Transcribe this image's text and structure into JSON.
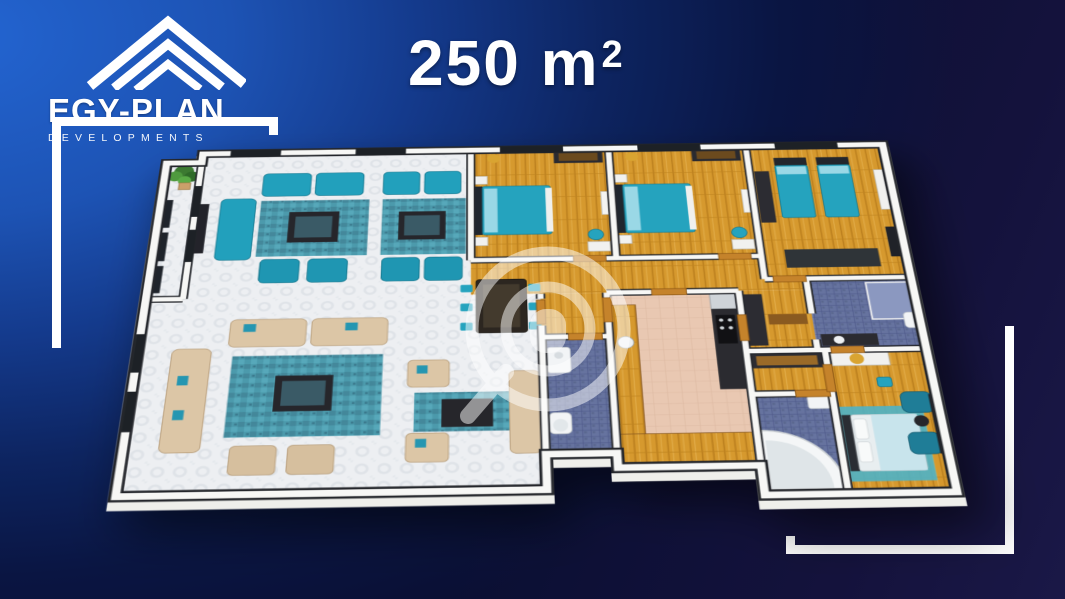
{
  "logo": {
    "brand": "EGY-PLAN",
    "tagline": "DEVELOPMENTS",
    "icon": "roof-chevrons"
  },
  "title": {
    "area": "250 m",
    "exponent": "2"
  },
  "watermark": {
    "icon": "house-search-magnifier"
  },
  "colors": {
    "bg-light": "#2365d2",
    "bg-dark": "#0a0f33",
    "bg-corner": "#1a1847",
    "text": "#ffffff",
    "frame": "#ffffff",
    "teal": "#25a3be",
    "teal-dark": "#1b7f9a",
    "wood": "#d6992e",
    "tile-blue": "#66739f",
    "kitchen-floor": "#e9c8b2",
    "sofa-beige": "#dcc6a6",
    "floor-white": "#edeff1",
    "wall": "#f6f6f4",
    "wall-edge": "#24262b"
  },
  "floorplan": {
    "rooms": [
      "balcony",
      "reception",
      "dining",
      "bedroom-1",
      "bedroom-2",
      "bedroom-3",
      "corridor",
      "bathroom",
      "kitchen",
      "dressing",
      "master-bathroom",
      "master-bedroom"
    ]
  }
}
